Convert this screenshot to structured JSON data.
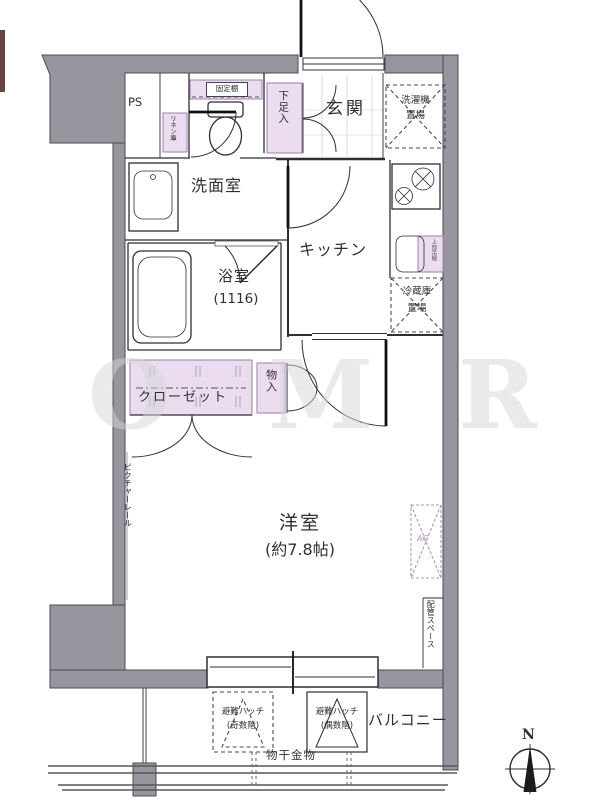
{
  "plan": {
    "title": "floor-plan",
    "compass_label": "N",
    "watermark_letters": [
      "O",
      "M",
      "R"
    ],
    "labels": {
      "ps": "PS",
      "fixed_shelf": "固定棚",
      "linen_closet": "リネン庫",
      "shoe_box": "下足入",
      "entrance": "玄関",
      "washing_machine_line1": "洗濯機",
      "washing_machine_line2": "置場",
      "washroom": "洗面室",
      "kitchen": "キッチン",
      "bathroom": "浴室",
      "bathroom_size": "(1116)",
      "overhead_shelf": "上部吊棚",
      "fridge_line1": "冷蔵庫",
      "fridge_line2": "置場",
      "closet": "クローゼット",
      "storage": "物入",
      "picture_rail": "ピクチャーレール",
      "main_room": "洋室",
      "main_room_size": "(約7.8帖)",
      "ac_unit": "AC",
      "pipe_space": "配管スペース",
      "balcony": "バルコニー",
      "hatch_odd_line1": "避難ハッチ",
      "hatch_odd_line2": "(奇数階)",
      "hatch_even_line1": "避難ハッチ",
      "hatch_even_line2": "(偶数階)",
      "laundry_hardware": "物干金物"
    },
    "colors": {
      "wall_gray": "#97969E",
      "wall_outline": "#4A4A52",
      "line": "#2E2E34",
      "purple_fill": "#EBDCF0",
      "purple_border": "#9B7FAD",
      "ac": "#B490C4",
      "text": "#2F2F33",
      "watermark": "#D6D6DA"
    }
  }
}
